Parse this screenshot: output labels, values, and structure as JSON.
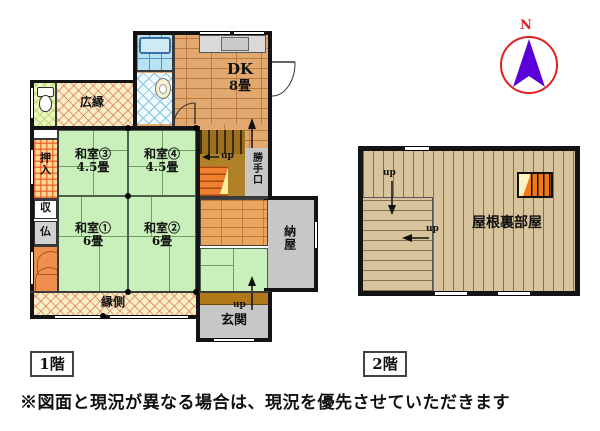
{
  "compass": {
    "north": "N"
  },
  "floor1": {
    "tag": "1階",
    "rooms": {
      "dk_name": "DK",
      "dk_size": "8畳",
      "hiroen": "広縁",
      "oshiire": "押入",
      "storage": "収",
      "altar": "仏",
      "washitsu3_name": "和室③",
      "washitsu3_size": "4.5畳",
      "washitsu4_name": "和室④",
      "washitsu4_size": "4.5畳",
      "washitsu1_name": "和室①",
      "washitsu1_size": "6畳",
      "washitsu2_name": "和室②",
      "washitsu2_size": "6畳",
      "katteguchi": "勝手口",
      "naya": "納屋",
      "engawa": "縁側",
      "genkan": "玄関"
    },
    "stairs_up": "up",
    "genkan_up": "up"
  },
  "floor2": {
    "tag": "2階",
    "attic": "屋根裏部屋",
    "up_top": "up",
    "up_mid": "up"
  },
  "footer": {
    "disclaimer": "※図面と現況が異なる場合は、現況を優先させていただきます"
  },
  "colors": {
    "tatami_green": "#c9f0bb",
    "dk_wood": "#e1a96f",
    "attic_plank": "#d7c49c",
    "compass_ring_red": "#e02020",
    "compass_needle_purple": "#5a00d8",
    "gray_room": "#c7c7c7"
  }
}
